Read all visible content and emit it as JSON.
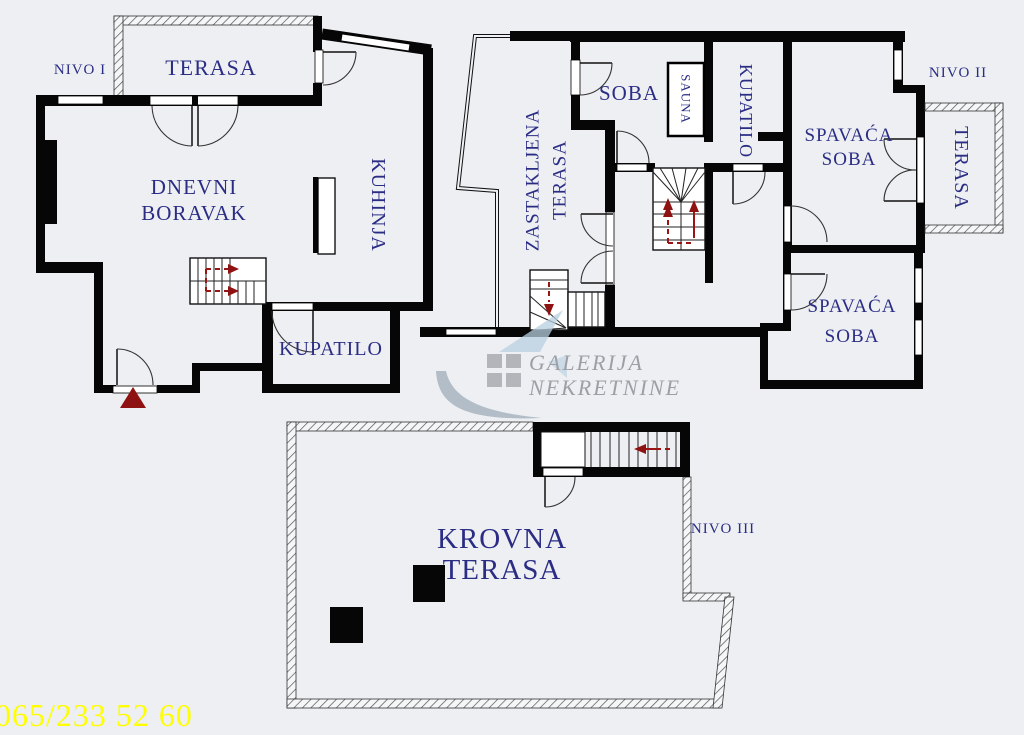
{
  "plan": {
    "level1": {
      "label": "NIVO I",
      "rooms": {
        "terasa": "TERASA",
        "dnevni_line1": "DNEVNI",
        "dnevni_line2": "BORAVAK",
        "kuhinja": "KUHINJA",
        "kupatilo": "KUPATILO"
      }
    },
    "level2": {
      "label": "NIVO II",
      "rooms": {
        "zastakljena_line1": "ZASTAKLJENA",
        "zastakljena_line2": "TERASA",
        "soba": "SOBA",
        "sauna": "SAUNA",
        "kupatilo": "KUPATILO",
        "spavaca1_line1": "SPAVAĆA",
        "spavaca1_line2": "SOBA",
        "terasa": "TERASA",
        "spavaca2_line1": "SPAVAĆA",
        "spavaca2_line2": "SOBA"
      }
    },
    "level3": {
      "label": "NIVO III",
      "rooms": {
        "krovna_line1": "KROVNA",
        "krovna_line2": "TERASA"
      }
    }
  },
  "watermark": {
    "line1": "GALERIJA",
    "line2": "NEKRETNINE"
  },
  "footer": {
    "phone": "065/233 52 60"
  },
  "colors": {
    "background": "#edeff2",
    "walls": "#060606",
    "room_label": "#2b2d85",
    "arrow_red": "#9b1414",
    "phone_yellow": "#ffff00",
    "watermark_gray": "#94959c",
    "watermark_blue": "#b9cfe0"
  }
}
